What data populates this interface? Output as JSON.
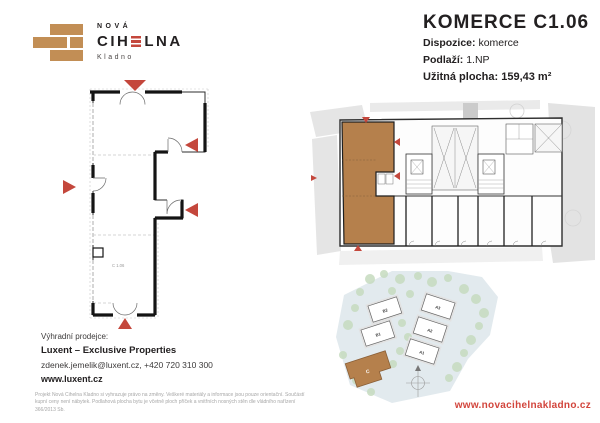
{
  "brand": {
    "name_top": "NOVÁ",
    "name_main_pre": "CIH",
    "name_main_post": "LNA",
    "city": "Kladno"
  },
  "header": {
    "title": "KOMERCE C1.06",
    "fields": [
      {
        "label": "Dispozice:",
        "value": "komerce"
      },
      {
        "label": "Podlaží:",
        "value": "1.NP"
      },
      {
        "label": "Užitná plocha:",
        "value": "159,43 m²"
      }
    ]
  },
  "floor_plan": {
    "unit_label": "C 1.06"
  },
  "site_plan": {
    "buildings": [
      "B2",
      "B1",
      "A3",
      "A2",
      "A1"
    ],
    "highlighted_building": "C"
  },
  "contact": {
    "heading": "Výhradní prodejce:",
    "company": "Luxent – Exclusive Properties",
    "email_phone": "zdenek.jemelik@luxent.cz, +420 720 310 300",
    "web": "www.luxent.cz"
  },
  "footer": {
    "disclaimer": "Projekt Nová Cihelna Kladno si vyhrazuje právo na změny. Veškeré materiály a informace jsou pouze orientační. Součástí kupní ceny není nábytek. Podlahová plocha bytu je včetně ploch příček a vnitřních nosných stěn dle vládního nařízení 366/2013 Sb.",
    "website": "www.novacihelnakladno.cz"
  },
  "colors": {
    "brick": "#C28E55",
    "accent_red": "#C4473C",
    "url_red": "#D2453C",
    "unit_brown": "#B5804C",
    "tree_green": "#C5DBBE",
    "ground_blue": "#E2EAEE",
    "text_dark": "#232021",
    "disclaimer_grey": "#A7A7A7"
  }
}
